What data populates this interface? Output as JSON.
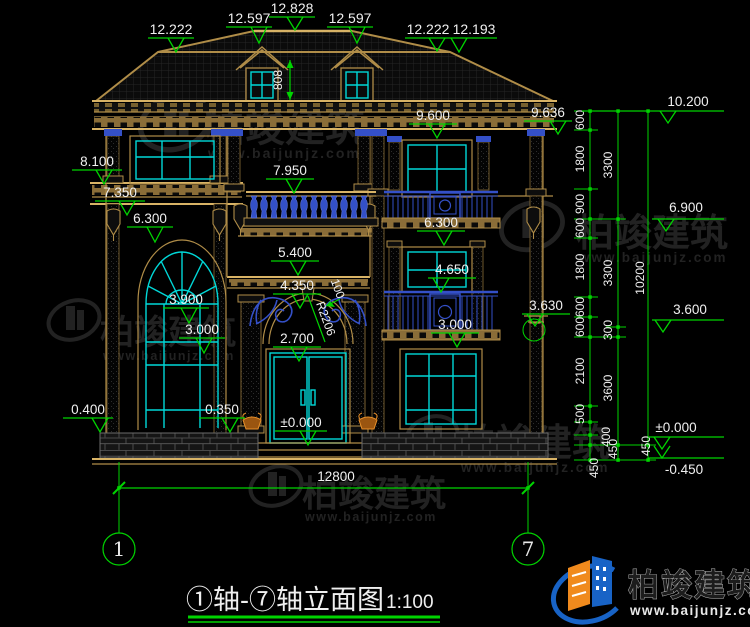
{
  "canvas": {
    "width": 750,
    "height": 627
  },
  "palette": {
    "green": "#00d400",
    "tan": "#b08d48",
    "cyan": "#00d8d8",
    "blue": "#3450c8",
    "white": "#f0f0f0",
    "orange": "#e8902a",
    "watermark_gray": "#3e3e3e",
    "logo_blue": "#1863c6",
    "logo_orange": "#f08a1d"
  },
  "title_block": {
    "title": "①轴-⑦轴立面图",
    "scale": "1:100"
  },
  "brand": {
    "name": "柏竣建筑",
    "url": "www.baijunjz.com"
  },
  "axes": {
    "left": "1",
    "right": "7"
  },
  "dims": {
    "total_width": "12800",
    "dormer_drop": "808",
    "arch_radius": "R2206",
    "arch_offset": "100",
    "chain_inner": [
      "600",
      "1800",
      "900",
      "600",
      "1800",
      "600",
      "600",
      "2100",
      "500",
      "400",
      "450"
    ],
    "chain_mid": [
      "3300",
      "3300",
      "300",
      "3600",
      "450",
      "450"
    ],
    "chain_outer": [
      "10200"
    ]
  },
  "marks": {
    "top": [
      "12.222",
      "12.597",
      "12.828",
      "12.597",
      "12.222",
      "12.193"
    ],
    "left": [
      "8.100",
      "7.350",
      "0.400"
    ],
    "left_inner": [
      "6.300",
      "3.900",
      "3.000",
      "0.350"
    ],
    "center": [
      "7.950",
      "5.400",
      "4.350",
      "2.700",
      "±0.000"
    ],
    "right_inner": [
      "9.600",
      "6.300",
      "4.650",
      "3.000"
    ],
    "right_face": [
      "9.636",
      "3.630"
    ],
    "right_side": [
      "10.200",
      "6.900",
      "3.600",
      "±0.000",
      "-0.450"
    ]
  }
}
